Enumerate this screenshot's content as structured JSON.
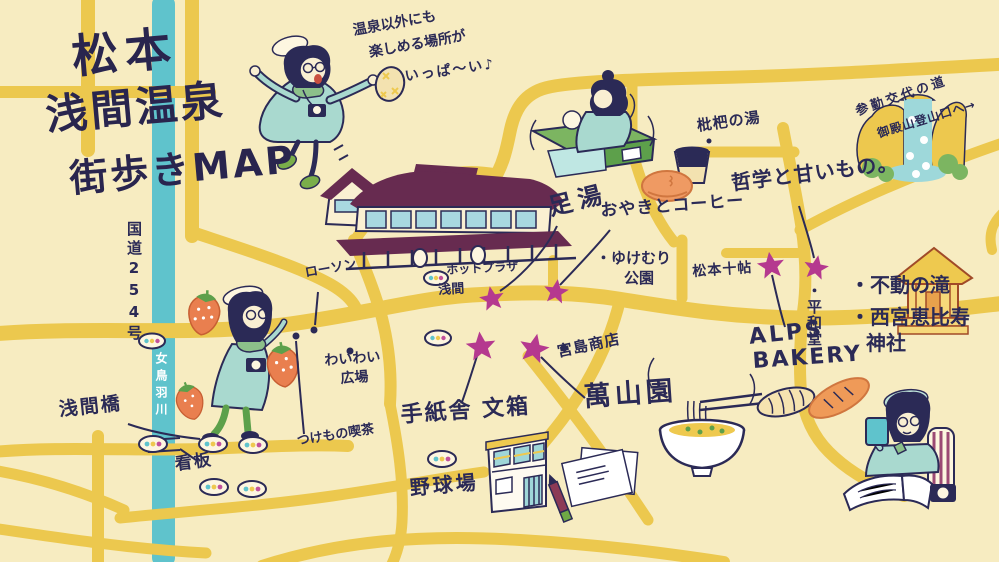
{
  "title": {
    "line1": "松本",
    "line2": "浅間温泉",
    "line3": "街歩きMAP"
  },
  "speech_bubble": {
    "line1": "温泉以外にも",
    "line2": "楽しめる場所が",
    "line3": "いっぱ〜い♪"
  },
  "labels": {
    "ashiyu": "足湯",
    "oyaki_coffee": "おやきとコーヒー",
    "biwa_no_yu": "枇杷の湯",
    "tetsugaku": "哲学と甘いもの。",
    "fudo_falls": "・不動の滝",
    "nishinomiya_line1": "・西宮恵比寿",
    "nishinomiya_line2": "神社",
    "sankin_line1": "参勤交代の道",
    "sankin_line2": "御殿山登山口へ→",
    "matsumoto_jujo": "松本十帖",
    "heiwado": "・平和堂",
    "alps_line1": "ALPS",
    "alps_line2": "BAKERY",
    "yukemuri_line1": "・ゆけむり",
    "yukemuri_line2": "公園",
    "hot_plaza_line1": "ホットプラザ",
    "hot_plaza_line2": "浅間",
    "lawson": "ローソン",
    "waiwai_line1": "わいわい",
    "waiwai_line2": "広場",
    "route254": "国道254号",
    "metoba_river": "女鳥羽川",
    "asama_bridge": "浅間橋",
    "kanban": "看板",
    "tsukemono_cafe": "つけもの喫茶",
    "tegamisha": "手紙舎 文箱",
    "yakyujo": "野球場",
    "miyajima_shoten": "宮島商店",
    "manzanen": "萬山園"
  },
  "colors": {
    "background": "#f7ecc1",
    "road": "#ecc84e",
    "river": "#5fc3cc",
    "ink": "#2b2a56",
    "star_marker": "#b5398f",
    "roof_plum": "#672b50",
    "clothing_teal": "#a9d9cf",
    "leaf_green": "#7cb561",
    "food_orange": "#ef9a63",
    "bread_cream": "#f5e3b0"
  }
}
